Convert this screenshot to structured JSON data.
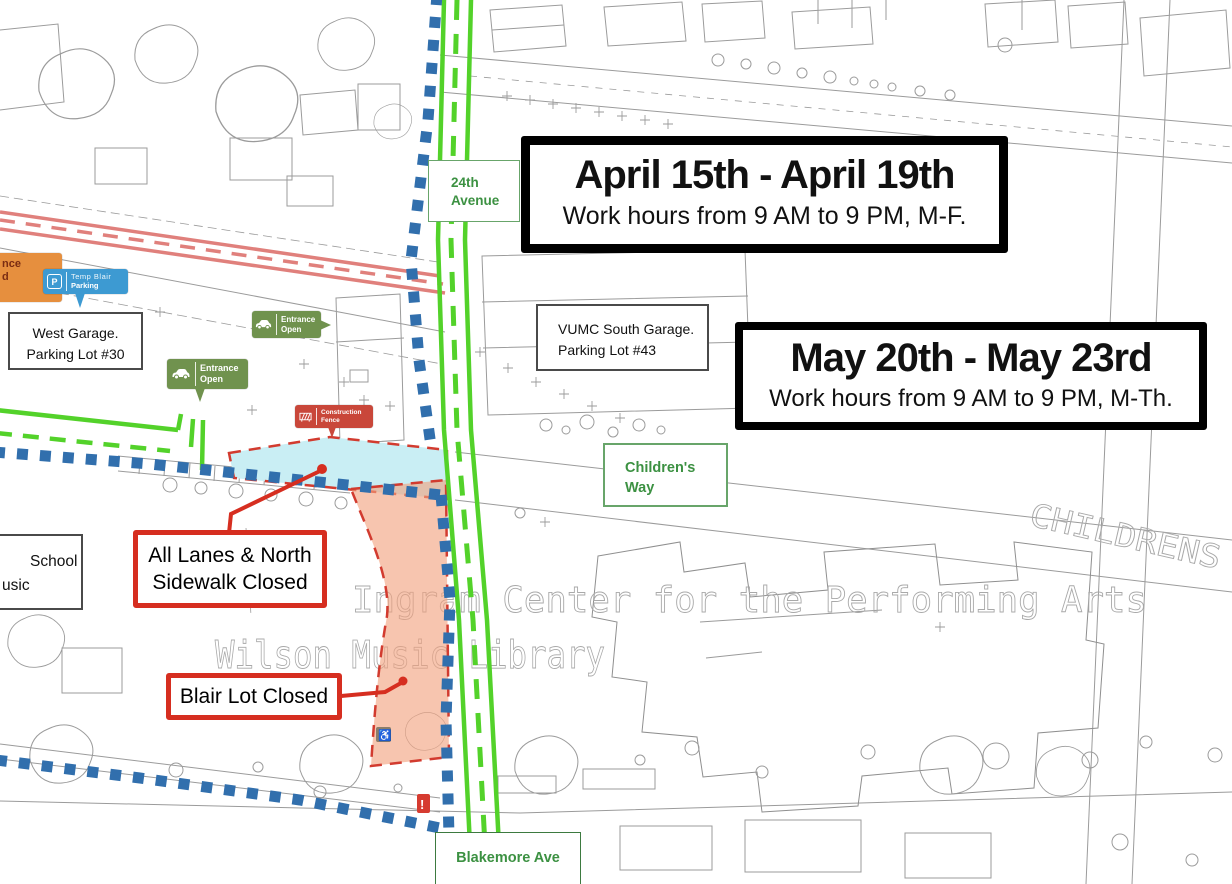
{
  "banners": {
    "april": {
      "title": "April 15th - April 19th",
      "subtitle": "Work hours from 9 AM to 9 PM, M-F."
    },
    "may": {
      "title": "May 20th - May 23rd",
      "subtitle": "Work hours from 9 AM to 9 PM, M-Th."
    }
  },
  "callouts": {
    "all_lanes": {
      "line1": "All Lanes & North",
      "line2": "Sidewalk Closed"
    },
    "blair_lot": {
      "label": "Blair Lot Closed"
    }
  },
  "street_labels": {
    "avenue_24th": {
      "line1": "24th",
      "line2": "Avenue"
    },
    "childrens_way": {
      "line1": "Children's",
      "line2": "Way"
    },
    "blakemore": {
      "label": "Blakemore Ave"
    }
  },
  "building_labels": {
    "west_garage": {
      "line1": "West Garage.",
      "line2": "Parking Lot #30"
    },
    "vumc_garage": {
      "line1": "VUMC South Garage.",
      "line2": "Parking Lot #43"
    },
    "school_partial": {
      "line1": "School",
      "line2": "usic"
    }
  },
  "map_tags": {
    "temp_blair_parking": {
      "icon": "parking-icon",
      "icon_letter": "P",
      "line1": "Temp Blair",
      "line2": "Parking"
    },
    "entrance_open_north": {
      "icon": "car-icon",
      "line1": "Entrance",
      "line2": "Open"
    },
    "entrance_open_south": {
      "icon": "car-icon",
      "line1": "Entrance",
      "line2": "Open"
    },
    "construction_fence": {
      "icon": "fence-icon",
      "line1": "Construction",
      "line2": "Fence"
    },
    "entrance_closed_partial": {
      "line1": "nce",
      "line2": "d"
    }
  },
  "faint_map_texts": {
    "performing_arts_center": "Ingram Center for the Performing Arts",
    "wilson_music_library": "Wilson Music Library",
    "childrens_street": "CHILDRENS"
  },
  "markers": {
    "accessible_parking": "♿",
    "alert": "!"
  },
  "colors": {
    "route_green": "#53d22a",
    "detour_blue": "#316fad",
    "closed_road_pink": "#e0807c",
    "closure_cyan": "#c9eef4",
    "closure_orange": "#f2a27e",
    "closure_border_red": "#d23b2f",
    "callout_red": "#d62e20",
    "tag_green": "#70924e",
    "tag_blue": "#3d9ad2",
    "tag_red": "#c9473a",
    "tag_orange": "#e68f3e",
    "street_label_green": "#3c9142"
  }
}
